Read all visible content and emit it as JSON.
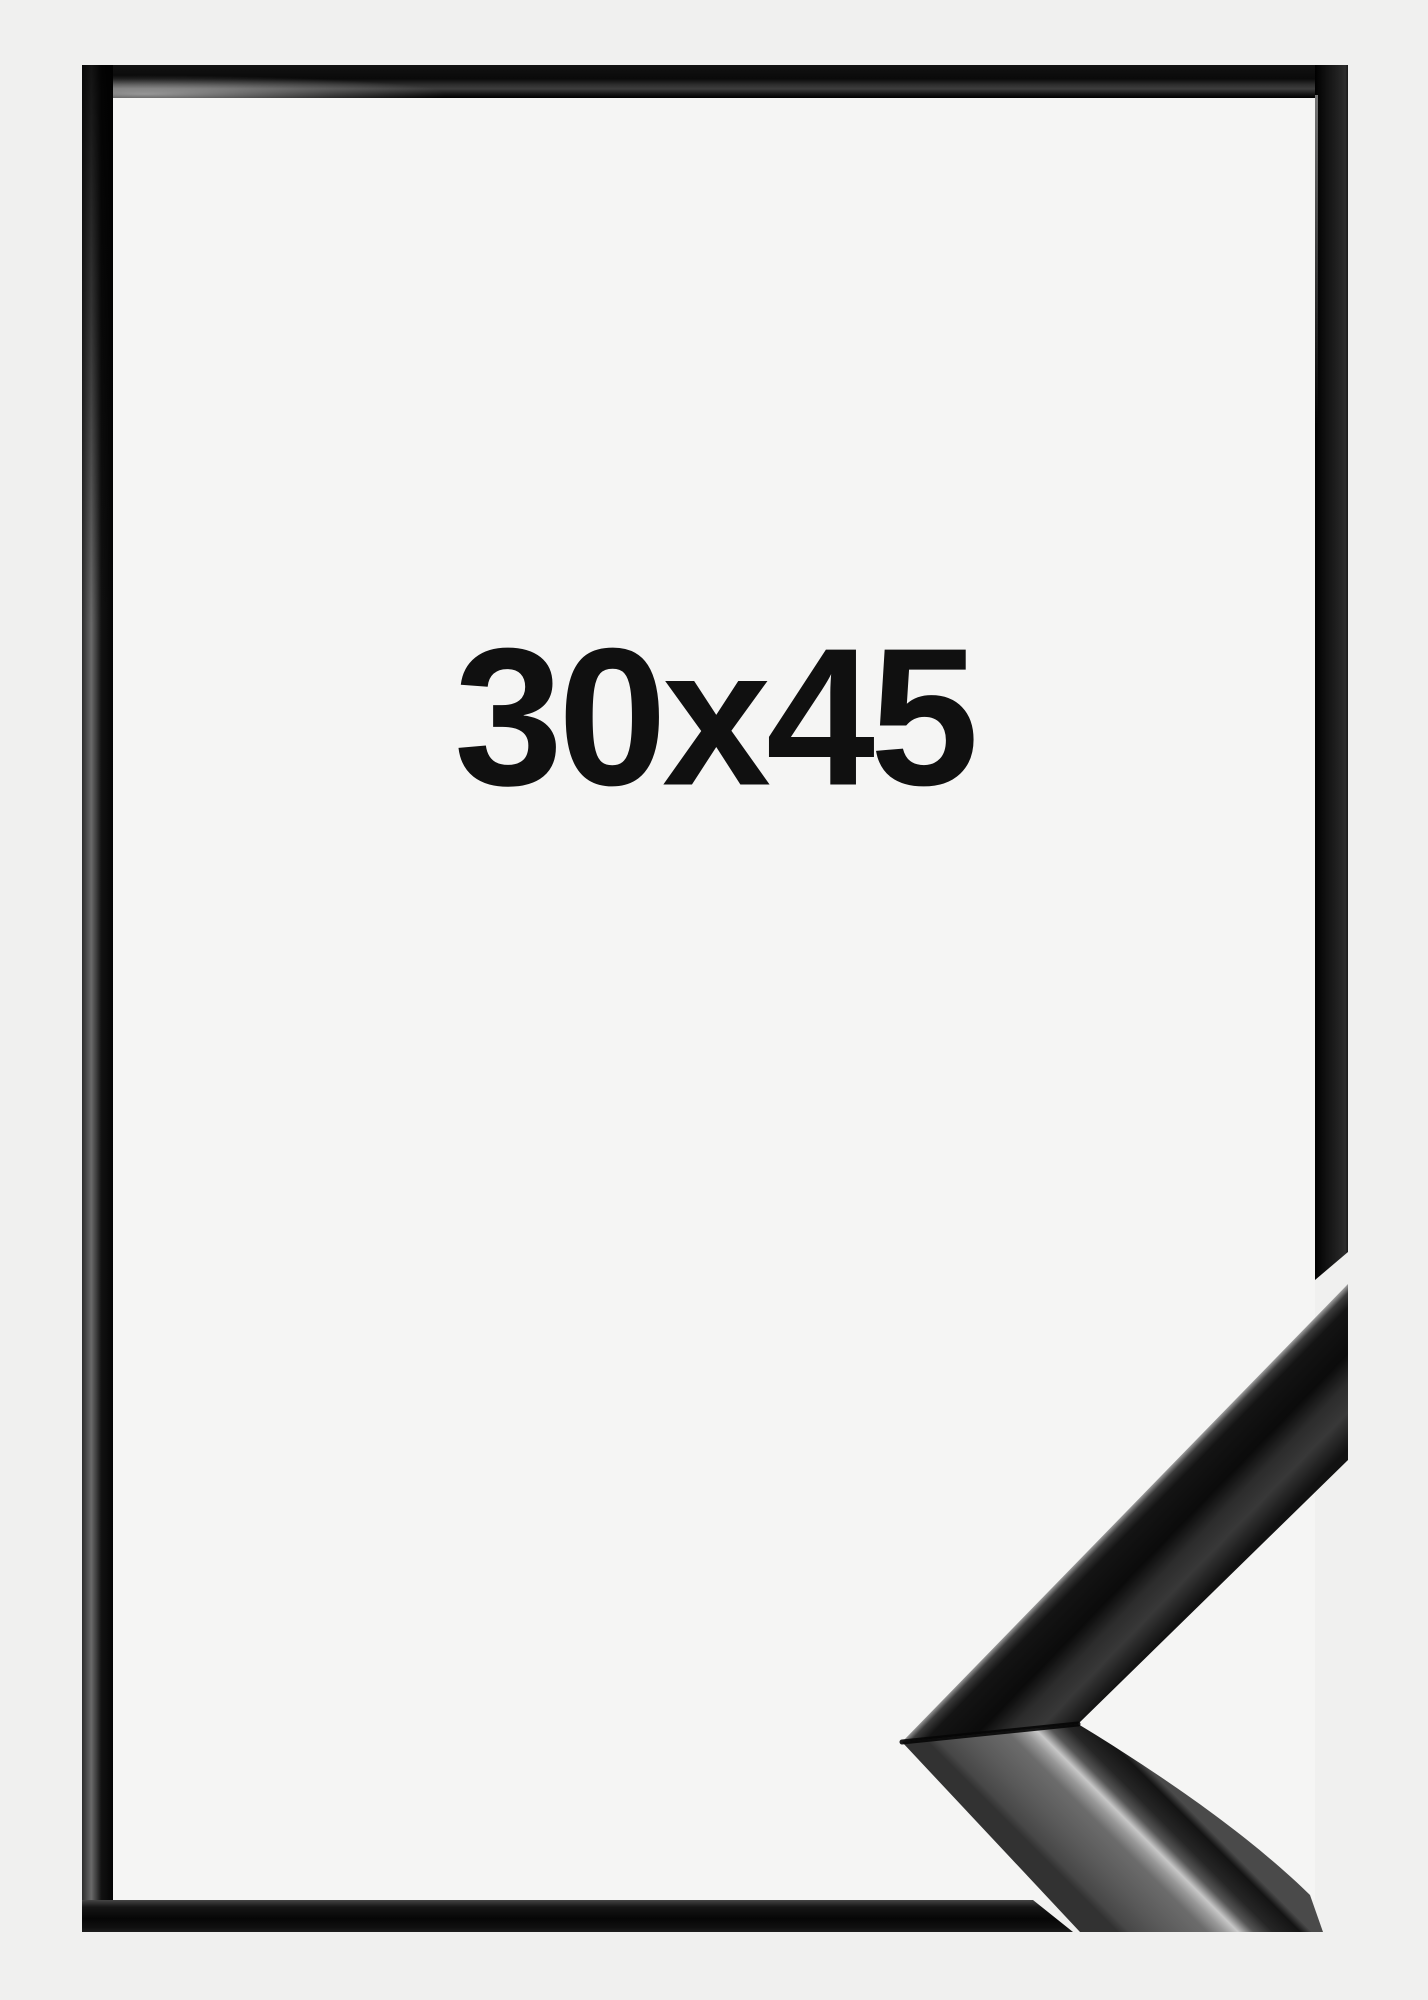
{
  "product_image": {
    "size_label": "30x45",
    "colors": {
      "page_background": "#f0f0ef",
      "frame_interior": "#f5f5f4",
      "frame_black": "#131313",
      "label_text": "#101010"
    }
  }
}
